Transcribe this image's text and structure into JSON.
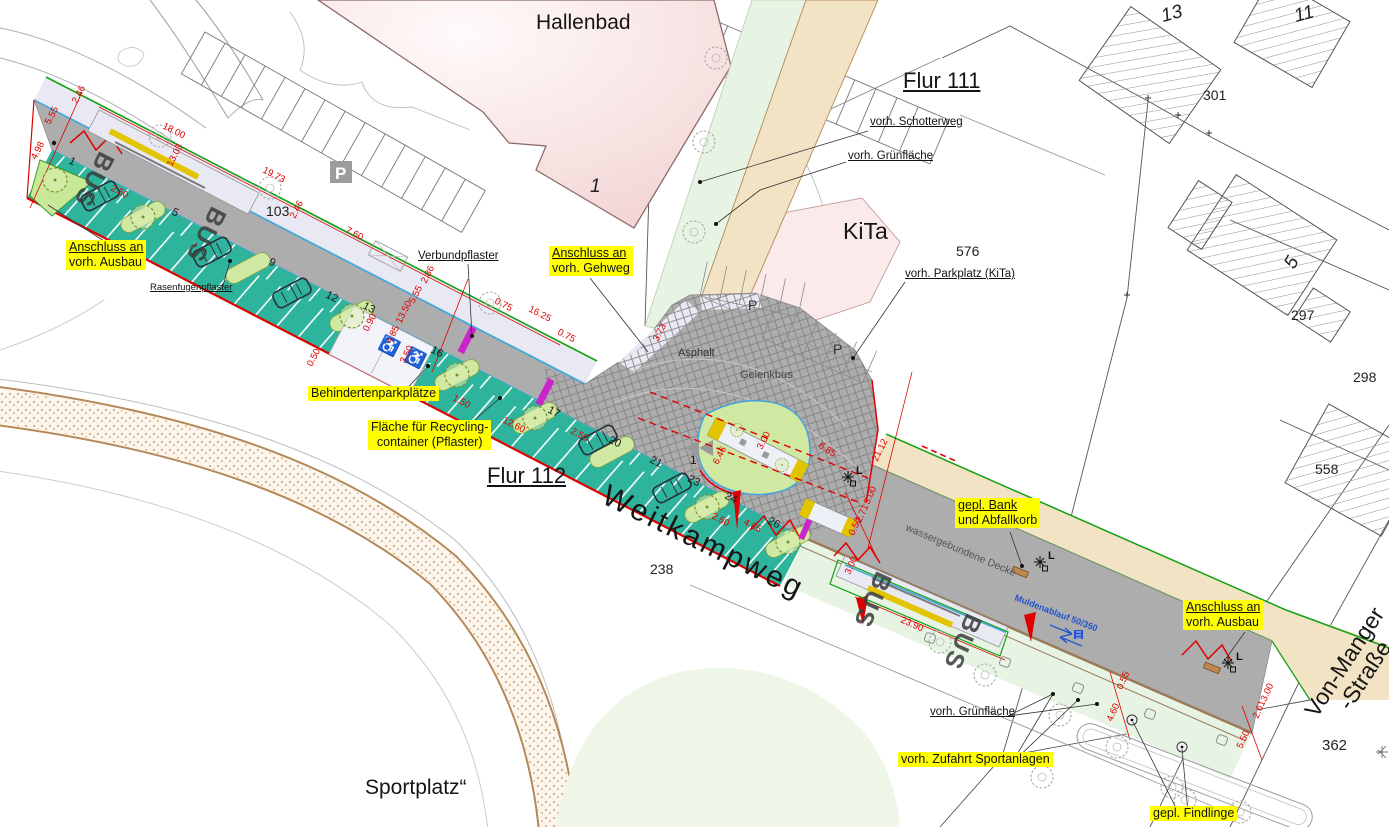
{
  "plan": {
    "areas": {
      "hallenbad": "Hallenbad",
      "kita": "KiTa",
      "sportplatz": "Sportplatz“",
      "flur_111": "Flur 111",
      "flur_112": "Flur 112"
    },
    "streets": {
      "weitkampweg": "Weitkampweg",
      "von_manger_line1": "Von-Manger",
      "von_manger_line2": "-Straße"
    },
    "parcels": {
      "p103": "103",
      "p238": "238",
      "p301": "301",
      "p297": "297",
      "p298": "298",
      "p558": "558",
      "p576": "576",
      "p362": "362"
    },
    "house_numbers": {
      "h13": "13",
      "h11": "11",
      "h5": "5",
      "h1": "1",
      "island_sign": "1"
    },
    "callouts": {
      "anschluss_ausbau_left": {
        "line1": "Anschluss an",
        "line2": "vorh. Ausbau"
      },
      "anschluss_gehweg": {
        "line1": "Anschluss an",
        "line2": "vorh. Gehweg"
      },
      "behindertenparkplaetze": "Behindertenparkplätze",
      "recycling": {
        "line1": "Fläche für Recycling-",
        "line2": "container (Pflaster)"
      },
      "bank_abfallkorb": {
        "line1": "gepl. Bank",
        "line2": "und Abfallkorb"
      },
      "anschluss_ausbau_right": {
        "line1": "Anschluss an",
        "line2": "vorh. Ausbau"
      },
      "zufahrt_sportanlagen": "vorh. Zufahrt Sportanlagen",
      "findlinge": "gepl. Findlinge"
    },
    "notes": {
      "schotterweg": "vorh. Schotterweg",
      "gruenflaeche_nord": "vorh. Grünfläche",
      "parkplatz_kita": "vorh. Parkplatz (KiTa)",
      "verbundpflaster": "Verbundpflaster",
      "rasenfugenpflaster": "Rasenfugenpflaster",
      "gruenflaeche_sued": "vorh. Grünfläche"
    },
    "surfaces": {
      "asphalt": "Asphalt",
      "gelenkbus": "Gelenkbus",
      "wassergebundene_decke": "wassergebundene Decke",
      "muldenablauf": "Muldenablauf 50/350"
    },
    "markings": {
      "bus": "BUS",
      "parking": "P",
      "lamp": "L"
    },
    "dimensions": [
      "2.46",
      "5.55",
      "4.98",
      "18.00",
      "19.73",
      "13.03",
      "2.50",
      "2.50",
      "7.60",
      "2.46",
      "16.25",
      "0.75",
      "0.75",
      "2.86",
      "5.55",
      "13.50",
      "4.85",
      "3.50",
      "0.90",
      "0.50",
      "1.50",
      "12.60",
      "3.73",
      "6.85",
      "21.12",
      "3.00",
      "6.46",
      "2.50",
      "4.85",
      "23.90",
      "3.00",
      "0.50",
      "2.71",
      "3.00",
      "0.55",
      "4.60",
      "5.50",
      "2.61",
      "3.00"
    ],
    "stall_numbers": [
      "1",
      "5",
      "9",
      "12",
      "13",
      "16",
      "17",
      "20",
      "21",
      "23",
      "24",
      "26"
    ],
    "colors": {
      "road": "#adadad",
      "parking_strip": "#2eb39c",
      "planting_island": "#cfe9a2",
      "sidewalk": "#e9e9f4",
      "tactile_paving": "#e2c400",
      "highlight": "#ffff00",
      "dimension_red": "#e00000",
      "building_pink": "#f6dada",
      "gravel_path": "#f2e3c5",
      "green_area": "#e7f4e3",
      "drain_blue": "#2255cc"
    }
  }
}
